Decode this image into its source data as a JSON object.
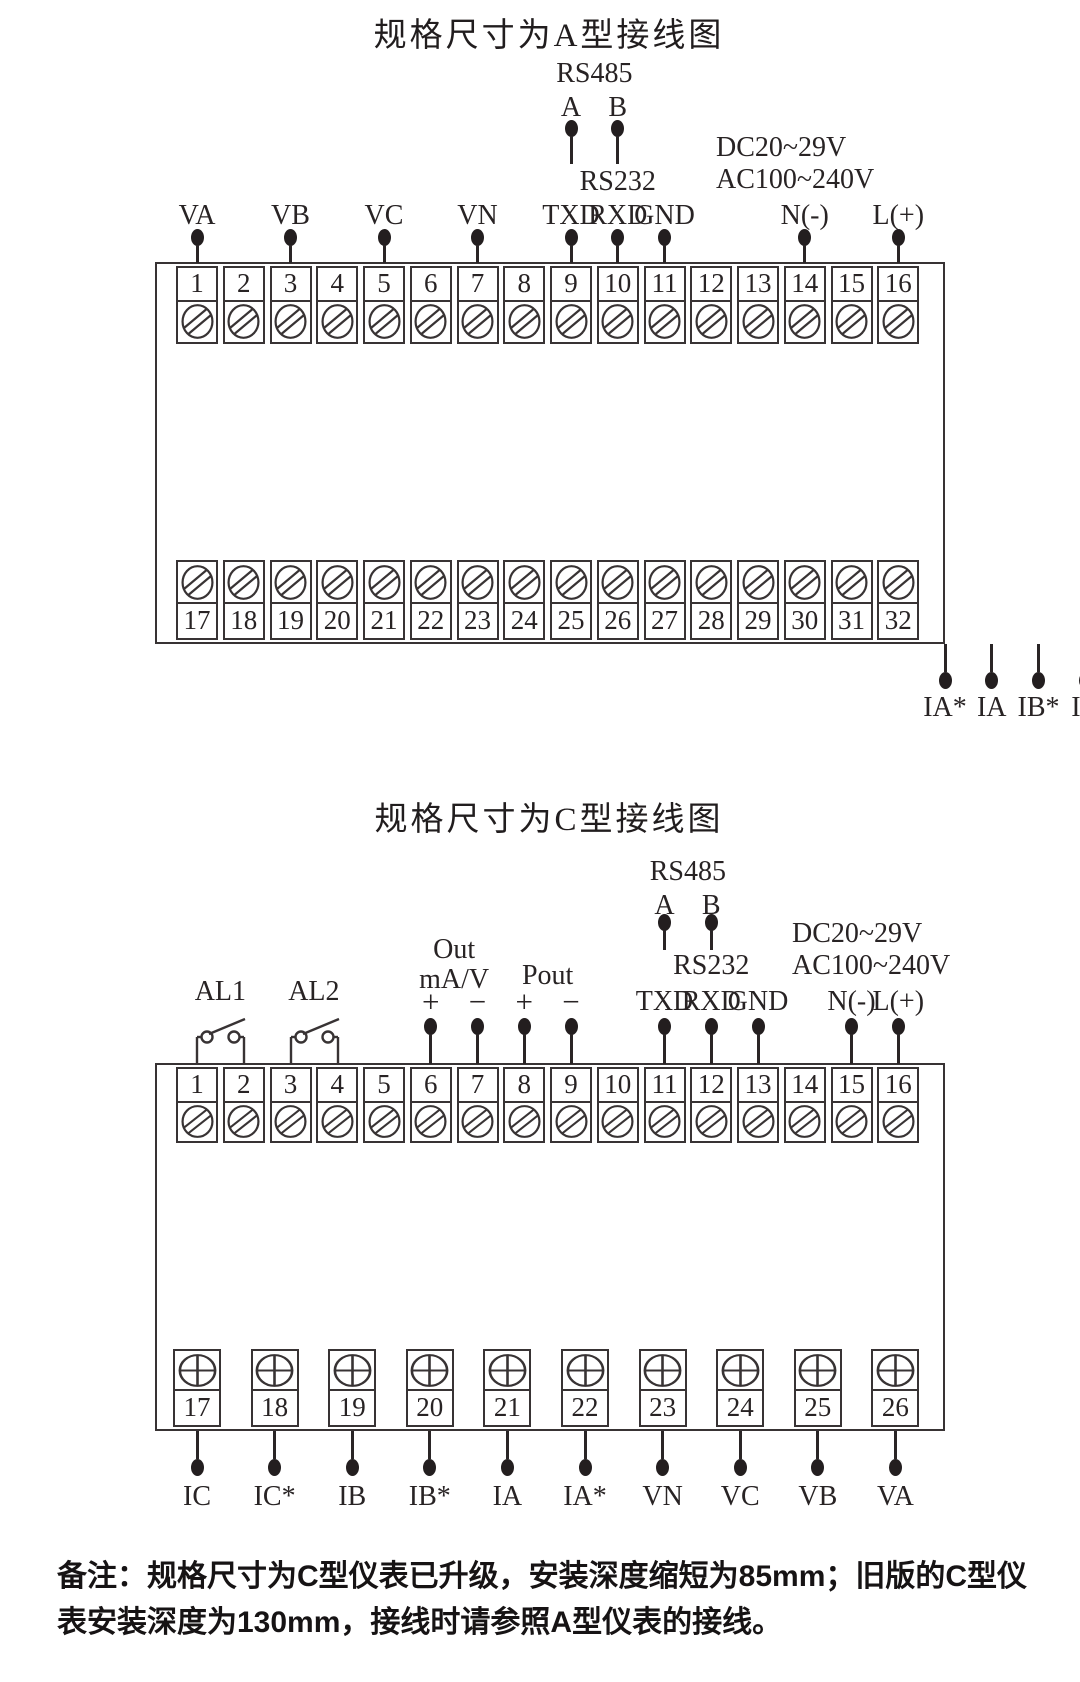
{
  "page": {
    "bg": "#ffffff",
    "ink": "#383334"
  },
  "diagram_a": {
    "title": "规格尺寸为A型接线图",
    "rs485_label": "RS485",
    "rs485_a": "A",
    "rs485_b": "B",
    "rs485_terminals": [
      9,
      10
    ],
    "rs232_label": "RS232",
    "power_dc": "DC20~29V",
    "power_ac": "AC100~240V",
    "terminals_top": [
      "1",
      "2",
      "3",
      "4",
      "5",
      "6",
      "7",
      "8",
      "9",
      "10",
      "11",
      "12",
      "13",
      "14",
      "15",
      "16"
    ],
    "terminals_bottom": [
      "17",
      "18",
      "19",
      "20",
      "21",
      "22",
      "23",
      "24",
      "25",
      "26",
      "27",
      "28",
      "29",
      "30",
      "31",
      "32"
    ],
    "top_wires": [
      {
        "label": "VA",
        "terminal": 1
      },
      {
        "label": "VB",
        "terminal": 3
      },
      {
        "label": "VC",
        "terminal": 5
      },
      {
        "label": "VN",
        "terminal": 7
      },
      {
        "label": "TXD",
        "terminal": 9
      },
      {
        "label": "RXD",
        "terminal": 10
      },
      {
        "label": "GND",
        "terminal": 11
      },
      {
        "label": "N(-)",
        "terminal": 14
      },
      {
        "label": "L(+)",
        "terminal": 16
      }
    ],
    "bottom_wires": [
      {
        "label": "IA*",
        "terminal": 17
      },
      {
        "label": "IA",
        "terminal": 18
      },
      {
        "label": "IB*",
        "terminal": 19
      },
      {
        "label": "IB",
        "terminal": 20
      },
      {
        "label": "IC*",
        "terminal": 21
      },
      {
        "label": "IC",
        "terminal": 22
      },
      {
        "label": "+",
        "terminal": 23
      },
      {
        "label": "−",
        "terminal": 24
      },
      {
        "label": "+",
        "terminal": 25
      },
      {
        "label": "−",
        "terminal": 26
      }
    ],
    "out_label": "Out",
    "out_unit": "mA/V",
    "pout_label": "Pout",
    "relays": [
      {
        "name": "AL1",
        "no": "NO",
        "nc": "NC",
        "terminals": [
          27,
          29
        ]
      },
      {
        "name": "AL2",
        "no": "NO",
        "nc": "NC",
        "terminals": [
          30,
          32
        ]
      }
    ]
  },
  "diagram_c": {
    "title": "规格尺寸为C型接线图",
    "rs485_label": "RS485",
    "rs485_a": "A",
    "rs485_b": "B",
    "rs485_terminals": [
      11,
      12
    ],
    "rs232_label": "RS232",
    "power_dc": "DC20~29V",
    "power_ac": "AC100~240V",
    "out_label": "Out",
    "out_unit": "mA/V",
    "pout_label": "Pout",
    "terminals_top": [
      "1",
      "2",
      "3",
      "4",
      "5",
      "6",
      "7",
      "8",
      "9",
      "10",
      "11",
      "12",
      "13",
      "14",
      "15",
      "16"
    ],
    "terminals_bottom": [
      "17",
      "18",
      "19",
      "20",
      "21",
      "22",
      "23",
      "24",
      "25",
      "26"
    ],
    "switches": [
      {
        "name": "AL1",
        "terminals": [
          1,
          2
        ]
      },
      {
        "name": "AL2",
        "terminals": [
          3,
          4
        ]
      }
    ],
    "top_wires": [
      {
        "label": "+",
        "terminal": 6
      },
      {
        "label": "−",
        "terminal": 7
      },
      {
        "label": "+",
        "terminal": 8
      },
      {
        "label": "−",
        "terminal": 9
      },
      {
        "label": "TXD",
        "terminal": 11
      },
      {
        "label": "RXD",
        "terminal": 12
      },
      {
        "label": "GND",
        "terminal": 13
      },
      {
        "label": "N(-)",
        "terminal": 15
      },
      {
        "label": "L(+)",
        "terminal": 16
      }
    ],
    "bottom_wires": [
      {
        "label": "IC",
        "terminal": 17
      },
      {
        "label": "IC*",
        "terminal": 18
      },
      {
        "label": "IB",
        "terminal": 19
      },
      {
        "label": "IB*",
        "terminal": 20
      },
      {
        "label": "IA",
        "terminal": 21
      },
      {
        "label": "IA*",
        "terminal": 22
      },
      {
        "label": "VN",
        "terminal": 23
      },
      {
        "label": "VC",
        "terminal": 24
      },
      {
        "label": "VB",
        "terminal": 25
      },
      {
        "label": "VA",
        "terminal": 26
      }
    ]
  },
  "note": {
    "label": "备注：",
    "text": "规格尺寸为C型仪表已升级，安装深度缩短为85mm；旧版的C型仪表安装深度为130mm，接线时请参照A型仪表的接线。"
  }
}
